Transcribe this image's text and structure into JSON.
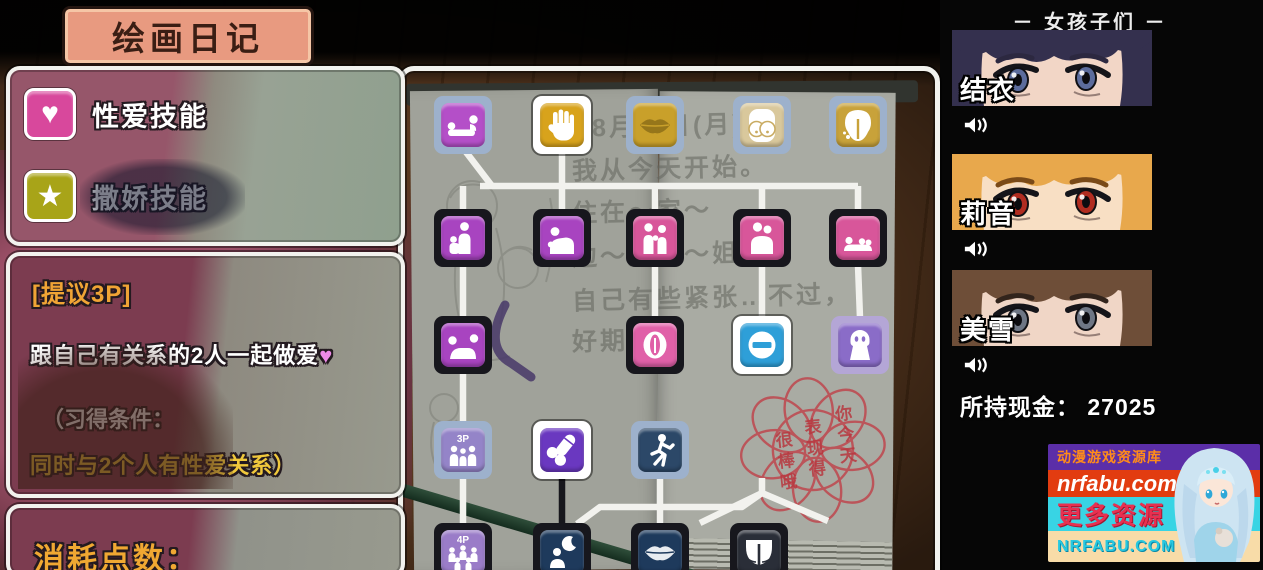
{
  "title_box": {
    "title": "绘画日记"
  },
  "skill_panel": {
    "items": [
      {
        "icon": "heart-icon",
        "glyph": "♥",
        "icon_color": "#d8489c",
        "label": "性爱技能"
      },
      {
        "icon": "star-icon",
        "glyph": "★",
        "icon_color": "#a8a418",
        "label": "撒娇技能"
      }
    ]
  },
  "detail_panel": {
    "skill_name": "[提议3P]",
    "description": "跟自己有关系的2人一起做爱",
    "heart": "♥",
    "condition_intro": "（习得条件：",
    "condition": "同时与2个人有性爱关系）"
  },
  "points_panel": {
    "label": "消耗点数："
  },
  "diary": {
    "lines": [
      "8月～日(月)～",
      "我从今天开始。",
      "住在～家～",
      "边～是我～姐姐",
      "自己有些紧张…不过，",
      "好期待～"
    ],
    "stamp_columns": [
      "你今天",
      "表现得",
      "很棒哦"
    ],
    "stamp_color": "#c04048"
  },
  "skill_tree": {
    "icons": [
      {
        "name": "lying-pose",
        "x": 463,
        "y": 125,
        "frame": "blue",
        "bg": "#b44fc8",
        "glyph": "pose_lying"
      },
      {
        "name": "hand",
        "x": 562,
        "y": 125,
        "frame": "white",
        "bg": "#d8a31c",
        "glyph": "hand"
      },
      {
        "name": "lips",
        "x": 655,
        "y": 125,
        "frame": "blue",
        "bg": "#c9a02a",
        "glyph": "lips_gold"
      },
      {
        "name": "breasts",
        "x": 762,
        "y": 125,
        "frame": "blue",
        "bg": "#d9c89c",
        "glyph": "breasts"
      },
      {
        "name": "hips",
        "x": 858,
        "y": 125,
        "frame": "blue",
        "bg": "#c8a23a",
        "glyph": "butt_gold"
      },
      {
        "name": "sitting-pose",
        "x": 463,
        "y": 238,
        "frame": "dark",
        "bg": "#a844c0",
        "glyph": "pose_sit"
      },
      {
        "name": "kneeling-pose",
        "x": 562,
        "y": 238,
        "frame": "dark",
        "bg": "#a844c0",
        "glyph": "pose_kneel"
      },
      {
        "name": "standing-pair",
        "x": 655,
        "y": 238,
        "frame": "dark",
        "bg": "#d8569a",
        "glyph": "couple"
      },
      {
        "name": "embrace",
        "x": 762,
        "y": 238,
        "frame": "dark",
        "bg": "#d8569a",
        "glyph": "hug"
      },
      {
        "name": "resting-pose",
        "x": 858,
        "y": 238,
        "frame": "dark",
        "bg": "#d8569a",
        "glyph": "pose_misc"
      },
      {
        "name": "doggy-pose",
        "x": 463,
        "y": 345,
        "frame": "dark",
        "bg": "#a844c0",
        "glyph": "pose_doggy"
      },
      {
        "name": "vulva",
        "x": 655,
        "y": 345,
        "frame": "dark",
        "bg": "#e060a8",
        "glyph": "vulva"
      },
      {
        "name": "locked",
        "x": 762,
        "y": 345,
        "frame": "white",
        "bg": "#2e9fd8",
        "glyph": "minus"
      },
      {
        "name": "ghost",
        "x": 860,
        "y": 345,
        "frame": "lav",
        "bg": "#8a6cc8",
        "glyph": "ghost"
      },
      {
        "name": "threesome-3p",
        "x": 463,
        "y": 450,
        "frame": "blue",
        "bg": "#9484c8",
        "glyph": "p3"
      },
      {
        "name": "penis",
        "x": 562,
        "y": 450,
        "frame": "white",
        "bg": "#6a38c0",
        "glyph": "penis"
      },
      {
        "name": "stamina",
        "x": 660,
        "y": 450,
        "frame": "blue",
        "bg": "#2c4868",
        "glyph": "run"
      },
      {
        "name": "foursome-4p",
        "x": 463,
        "y": 552,
        "frame": "dark",
        "bg": "#9a7cc8",
        "glyph": "p4"
      },
      {
        "name": "night-visit",
        "x": 562,
        "y": 552,
        "frame": "dark",
        "bg": "#1e3a5c",
        "glyph": "night"
      },
      {
        "name": "lips-night",
        "x": 660,
        "y": 552,
        "frame": "dark",
        "bg": "#1e3a5c",
        "glyph": "lips_dark"
      },
      {
        "name": "hips-night",
        "x": 759,
        "y": 552,
        "frame": "dark",
        "bg": "#2a2e38",
        "glyph": "panties"
      }
    ],
    "connectors": [
      {
        "points": "562,154 562,186"
      },
      {
        "points": "466,152 492,186"
      },
      {
        "points": "480,186 858,186"
      },
      {
        "points": "463,186 463,211"
      },
      {
        "points": "562,186 562,211"
      },
      {
        "points": "655,186 655,211"
      },
      {
        "points": "762,186 762,211"
      },
      {
        "points": "858,186 858,211"
      },
      {
        "points": "463,265 463,318"
      },
      {
        "points": "655,265 655,318"
      },
      {
        "points": "762,265 762,318"
      },
      {
        "points": "858,265 860,318"
      },
      {
        "points": "463,372 463,423"
      },
      {
        "points": "463,477 463,527"
      },
      {
        "points": "660,477 660,527"
      },
      {
        "points": "562,477 562,527",
        "color": "#17171c"
      },
      {
        "points": "577,524 600,507 742,507 762,493"
      },
      {
        "points": "762,478 762,493"
      },
      {
        "points": "762,493 828,521"
      },
      {
        "points": "762,493 700,523"
      }
    ]
  },
  "girls_panel": {
    "header": "－ 女孩子们 －",
    "girls": [
      {
        "name": "结衣",
        "hair": "#34304e",
        "skin": "#f2d6c6",
        "iris": "#5c6c9c",
        "brow": "#2c2840"
      },
      {
        "name": "莉音",
        "hair": "#e8a84c",
        "skin": "#f8dfc4",
        "iris": "#b02c20",
        "brow": "#7a4a18"
      },
      {
        "name": "美雪",
        "hair": "#6e4e38",
        "skin": "#f0d6c6",
        "iris": "#6e7684",
        "brow": "#32241c"
      }
    ],
    "cash_label": "所持现金：",
    "cash_value": "27025"
  },
  "watermark": {
    "line1": "动漫游戏资源库",
    "line2": "nrfabu.com",
    "line3": "更多资源",
    "line4": "NRFABU.COM",
    "colors": {
      "line1_bg": "#5b2ea8",
      "line1_fg": "#ff8c1a",
      "line2_bg": "#e23c10",
      "line2_fg": "#ffffff",
      "line3_bg": "#38d4e4",
      "line3_fg": "#e83050",
      "line4_bg": "#f8dca8",
      "line4_fg": "#28c8e0"
    }
  }
}
